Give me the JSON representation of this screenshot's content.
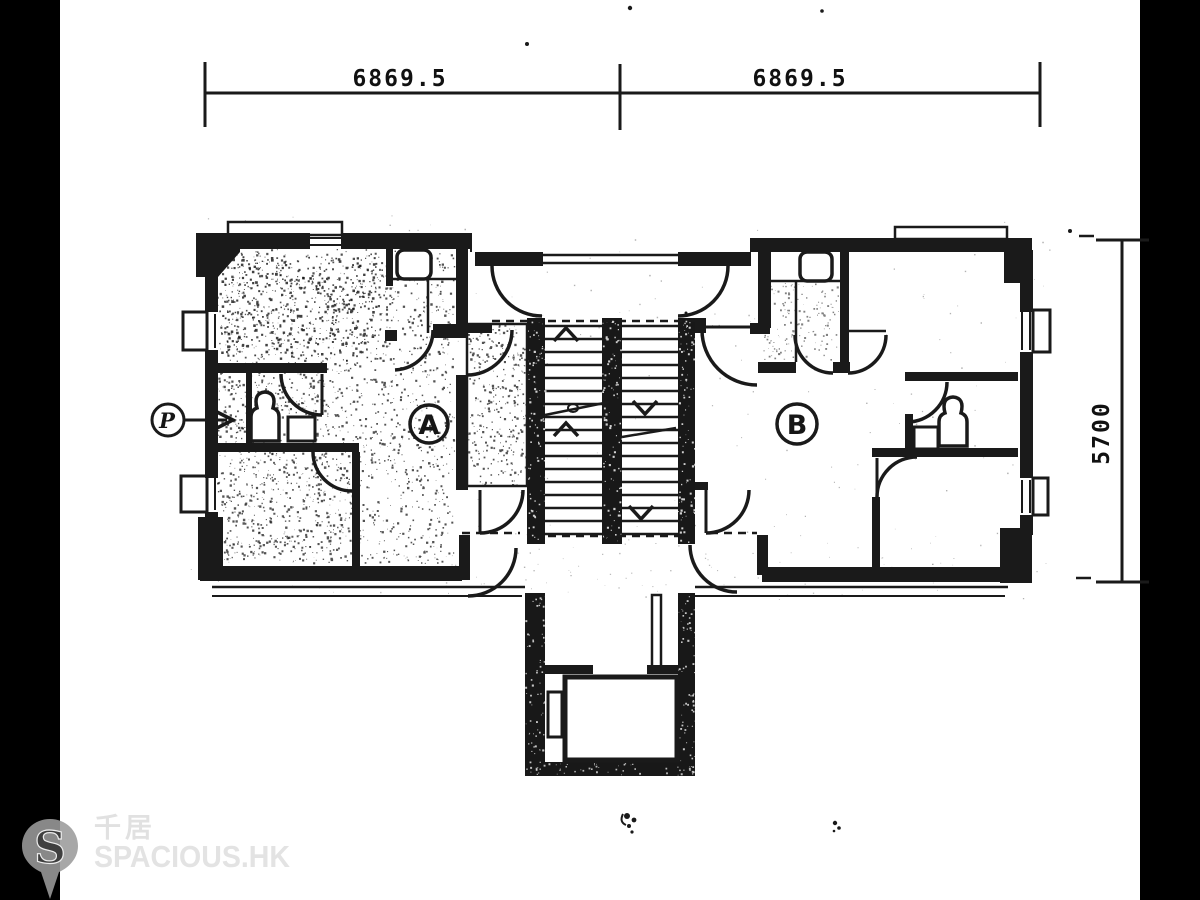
{
  "dimensions": {
    "top_segment_1": "6869.5",
    "top_segment_2": "6869.5",
    "right_height": "5700"
  },
  "labels": {
    "unit_a": "A",
    "unit_b": "B",
    "pipe_marker": "P"
  },
  "watermark": {
    "pin_letter": "S",
    "brand_cn": "千居",
    "brand_en": "SPACIOUS.HK"
  },
  "colors": {
    "ink": "#1a1a1a",
    "paper": "#ffffff",
    "pillarbox": "#000000",
    "watermark_pin": "#9b9b9b",
    "watermark_text": "#e3e3e3"
  }
}
